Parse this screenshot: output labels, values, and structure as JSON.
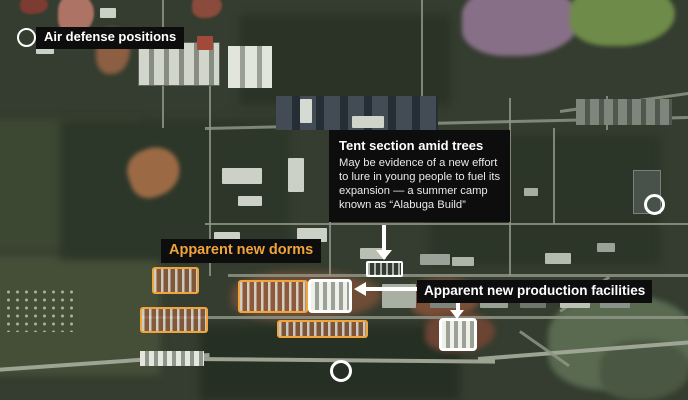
{
  "annotations": {
    "air_defense": {
      "label": "Air defense positions"
    },
    "dorms": {
      "label": "Apparent new dorms"
    },
    "production": {
      "label": "Apparent new production facilities"
    },
    "tent": {
      "title": "Tent section amid trees",
      "body": "May be evidence of a new effort\nto lure in young people to fuel its\nexpansion — a summer camp\nknown as “Alabuga Build”"
    }
  },
  "markers": {
    "circles": [
      "air-defense-site",
      "site-right",
      "site-bottom"
    ],
    "highlight_boxes": [
      "tent-section",
      "facility-west",
      "facility-east"
    ],
    "dorm_outline_count": 4
  },
  "colors": {
    "accent_orange": "#F0A43C",
    "label_bg": "#0D0D0D",
    "marker_white": "#FFFFFF"
  }
}
